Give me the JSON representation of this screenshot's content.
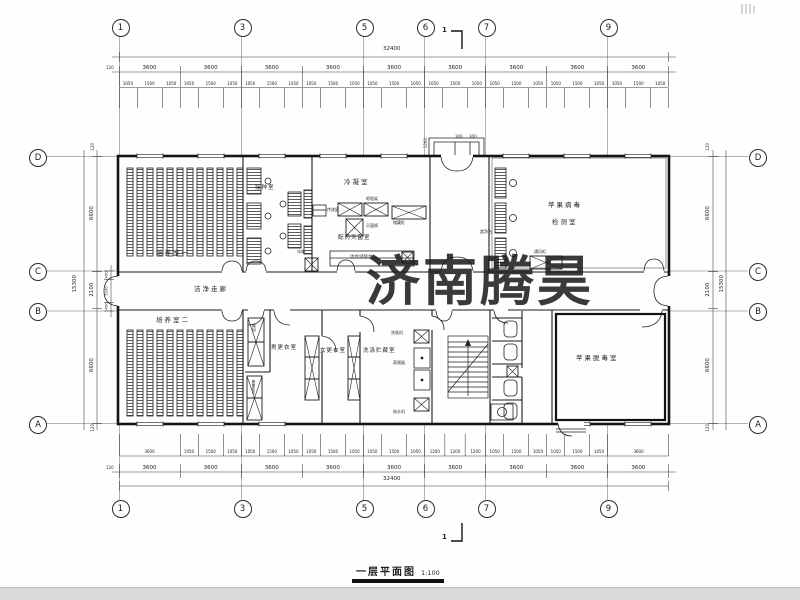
{
  "meta": {
    "watermark_text": "济南腾昊",
    "watermark_color": "#e23b41",
    "title": "一层平面图",
    "title_scale": "1:100",
    "section_mark": "1"
  },
  "grid": {
    "top": [
      "1",
      "3",
      "5",
      "6",
      "7",
      "9"
    ],
    "bottom": [
      "1",
      "3",
      "5",
      "6",
      "7",
      "9"
    ],
    "left": [
      "D",
      "C",
      "B",
      "A"
    ],
    "right": [
      "D",
      "C",
      "B",
      "A"
    ]
  },
  "dims": {
    "top_overall": "32400",
    "bottom_overall": "32400",
    "edge": "120",
    "top_bays": [
      "3600",
      "3600",
      "3600",
      "3600",
      "3600",
      "3600",
      "3600",
      "3600",
      "3600"
    ],
    "bottom_bays": [
      "3600",
      "3600",
      "3600",
      "3600",
      "3600",
      "3600",
      "3600",
      "3600",
      "3600"
    ],
    "top_sub": [
      "1050",
      "1500",
      "1050",
      "1050",
      "1500",
      "1050",
      "1050",
      "1500",
      "1050",
      "1050",
      "1500",
      "1050",
      "1050",
      "1500",
      "1050",
      "1050",
      "1500",
      "1050",
      "1050",
      "1500",
      "1050",
      "1050",
      "1500",
      "1050",
      "1050",
      "1500",
      "1050"
    ],
    "bottom_sub": [
      "3600",
      "1050",
      "1500",
      "1050",
      "1050",
      "1500",
      "1050",
      "1050",
      "1500",
      "1050",
      "1050",
      "1500",
      "1050",
      "1200",
      "1200",
      "1200",
      "1050",
      "1500",
      "1050",
      "1050",
      "1500",
      "1050",
      "3600"
    ],
    "left_overall": "15300",
    "right_overall": "15300",
    "left_chain": [
      "6600",
      "2100",
      "6600"
    ],
    "right_chain": [
      "6600",
      "2100",
      "6600"
    ],
    "left_corridor": [
      "450",
      "1200",
      "450"
    ],
    "entrance_depth": "1200",
    "entrance_steps": [
      "300",
      "300"
    ]
  },
  "rooms": {
    "culture1": "培养室一",
    "culture2": "培养室二",
    "inoculation": "接种室",
    "condensation": "冷凝室",
    "prep_steril": "配药灭菌室",
    "virus_test_line1": "苹果病毒",
    "virus_test_line2": "检测室",
    "clean_corridor": "洁净走廊",
    "men_change": "男更衣室",
    "women_change": "女更衣室",
    "wash_storage": "洗涤贮藏室",
    "detox": "苹果脱毒室"
  },
  "equipment": {
    "bottle_rack": "晾瓶架",
    "autoclave": "灭菌锅",
    "storage_cabinet": "储藏柜",
    "side_bench": "边台试验台",
    "fridge": "冰箱",
    "pass_window": "传递窗",
    "clean_bench": "超净台",
    "fume_hood": "通风柜",
    "air_shower": "风淋",
    "hand_sanitizer": "手消毒器",
    "bottle_washer": "洗瓶机",
    "distiller": "蒸馏器",
    "water_purifier": "纯水机"
  }
}
